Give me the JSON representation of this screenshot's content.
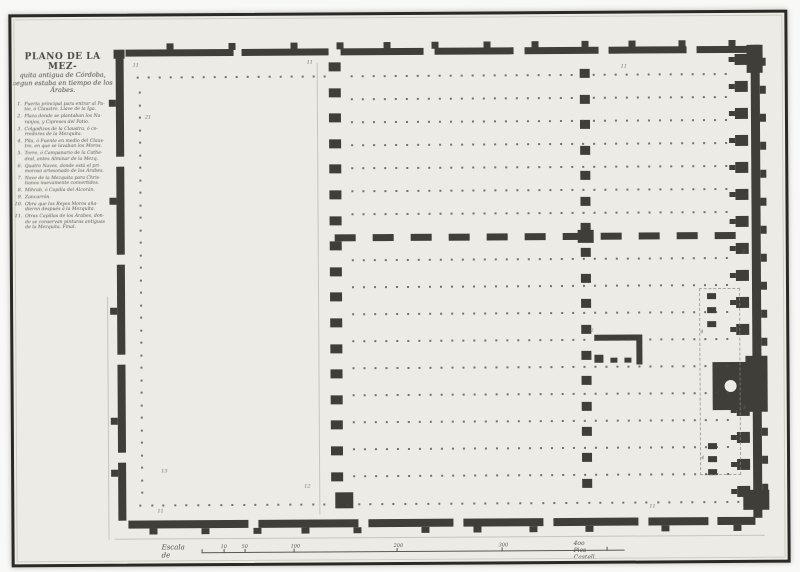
{
  "sheet": {
    "title_lines": [
      "PLANO DE LA MEZ-",
      "quita antigua de Córdoba,",
      "segun estaba en tiempo de los",
      "Árabes."
    ],
    "legend_items": [
      {
        "n": "1.",
        "text": "Puerta principal para entrar al Pa-\ntio, ó Claustro. Llave de la Iga."
      },
      {
        "n": "2.",
        "text": "Plaza donde se plantaban los Na-\nranjos, y Cipreses del Patio."
      },
      {
        "n": "3.",
        "text": "Colgadizos de la Claustra, ó co-\nrredores de la Mezquita."
      },
      {
        "n": "4.",
        "text": "Pila, ó Fuente en medio del Claus-\ntro, en que se lavaban los Moros."
      },
      {
        "n": "5.",
        "text": "Torre, ó Campanario de la Cathe-\ndral, antes Alminar de la Mezq."
      },
      {
        "n": "6.",
        "text": "Quatro Naves, donde está el pri-\nmoroso artesonado de los Árabes."
      },
      {
        "n": "7.",
        "text": "Nave de la Mezquita para Chris-\ntianos nuevamente convertidos."
      },
      {
        "n": "8.",
        "text": "Mihrab, ó Capilla del Alcorán."
      },
      {
        "n": "9.",
        "text": "Zancarrón."
      },
      {
        "n": "10.",
        "text": "Obra que los Reyes Moros aña-\ndieron después á la Mezquita."
      },
      {
        "n": "11.",
        "text": "Otras Capillas de los Árabes, don-\nde se conservan pinturas antiguas\nde la Mezquita. Final."
      }
    ],
    "scale": {
      "label": "Escala de",
      "end_label": "4oo Pies Castell.",
      "ticks": [
        {
          "x": 200,
          "t": ""
        },
        {
          "x": 222,
          "t": "10"
        },
        {
          "x": 243,
          "t": "50"
        },
        {
          "x": 292,
          "t": "100"
        },
        {
          "x": 395,
          "t": "200"
        },
        {
          "x": 500,
          "t": "300"
        },
        {
          "x": 605,
          "t": ""
        }
      ]
    }
  },
  "plan": {
    "ink": "#403e38",
    "dot": "#4c4a44",
    "walls": {
      "top_segments": [
        [
          127,
          48,
          108
        ],
        [
          243,
          48,
          87
        ],
        [
          342,
          48,
          83
        ],
        [
          436,
          48,
          79
        ],
        [
          526,
          48,
          74
        ],
        [
          610,
          48,
          78
        ],
        [
          698,
          48,
          56
        ]
      ],
      "top_buttresses": [
        168,
        230,
        292,
        338,
        385,
        433,
        485,
        533,
        583,
        630,
        680,
        730
      ],
      "left_segments": [
        [
          117,
          55,
          100
        ],
        [
          117,
          165,
          88
        ],
        [
          117,
          263,
          90
        ],
        [
          117,
          363,
          88
        ],
        [
          117,
          461,
          58
        ]
      ],
      "left_buttresses": [
        98,
        196,
        306,
        416,
        468
      ],
      "bottom_segments": [
        [
          127,
          519,
          120
        ],
        [
          257,
          519,
          100
        ],
        [
          367,
          519,
          85
        ],
        [
          462,
          519,
          80
        ],
        [
          552,
          519,
          85
        ],
        [
          647,
          519,
          60
        ],
        [
          716,
          519,
          38
        ]
      ],
      "bottom_buttresses": [
        148,
        200,
        252,
        300,
        352,
        420,
        472,
        528,
        584,
        660,
        732
      ],
      "right_wall": [
        752,
        47,
        9,
        473
      ],
      "right_buttresses": [
        60,
        88,
        116,
        144,
        172,
        200,
        228,
        256,
        284,
        312,
        340,
        430,
        458,
        486
      ]
    },
    "blocks": [
      [
        334,
        492,
        18,
        16
      ],
      [
        742,
        492,
        26,
        20
      ],
      [
        748,
        47,
        16,
        28
      ],
      [
        745,
        358,
        22,
        56
      ],
      [
        578,
        231,
        16,
        13
      ],
      [
        115,
        48,
        11,
        9
      ]
    ],
    "piers_a": {
      "x": 330,
      "y0": 62,
      "step": 25.6,
      "count": 17,
      "w": 12,
      "h": 9
    },
    "piers_b": {
      "x": 581,
      "y0": 70,
      "step": 25.6,
      "count": 17,
      "w": 10,
      "h": 9
    },
    "dashed_wall": {
      "y": 234,
      "x0": 335,
      "step": 38,
      "count": 11,
      "w": 21,
      "h": 7
    },
    "chapels": {
      "x": 736,
      "y0": 56,
      "step": 27,
      "count": 17,
      "w": 13,
      "h": 11,
      "skip": [
        11,
        12
      ]
    },
    "mihrab": {
      "rect": [
        712,
        364,
        42,
        48
      ],
      "hole": [
        724,
        382,
        12
      ]
    },
    "small_rects": [
      [
        707,
        295
      ],
      [
        707,
        309
      ],
      [
        707,
        323
      ],
      [
        707,
        445
      ],
      [
        707,
        458
      ],
      [
        707,
        471
      ]
    ],
    "small_chapel": [
      [
        594,
        336,
        46,
        6
      ],
      [
        636,
        336,
        6,
        30
      ],
      [
        594,
        356,
        9,
        8
      ],
      [
        610,
        359,
        7,
        5
      ],
      [
        624,
        359,
        7,
        5
      ]
    ],
    "chapel_outline": [
      699,
      290,
      39,
      185
    ],
    "grids": [
      {
        "x0": 352,
        "dx": 11,
        "cols": 35,
        "y0": 75,
        "dy": 23,
        "rows": 7
      },
      {
        "x0": 352,
        "dx": 11,
        "cols": 35,
        "y0": 259,
        "dy": 27,
        "rows": 9
      },
      {
        "x0": 138,
        "dx": 11,
        "cols": 18,
        "y0": 75,
        "dy": 1,
        "rows": 1
      },
      {
        "x0": 140,
        "dx": 1,
        "cols": 1,
        "y0": 90,
        "dy": 12.5,
        "rows": 33
      },
      {
        "x0": 138,
        "dx": 11.5,
        "cols": 53,
        "y0": 503,
        "dy": 1,
        "rows": 1
      }
    ],
    "faint_lines": [
      [
        107,
        295,
        1,
        243
      ],
      [
        113,
        537,
        650,
        1
      ],
      [
        318,
        62,
        1,
        452
      ]
    ],
    "numerals": [
      {
        "x": 134,
        "y": 62,
        "t": "11"
      },
      {
        "x": 308,
        "y": 60,
        "t": "11"
      },
      {
        "x": 622,
        "y": 66,
        "t": "11"
      },
      {
        "x": 146,
        "y": 114,
        "t": "21"
      },
      {
        "x": 160,
        "y": 468,
        "t": "13"
      },
      {
        "x": 303,
        "y": 484,
        "t": "12"
      },
      {
        "x": 156,
        "y": 508,
        "t": "11"
      },
      {
        "x": 648,
        "y": 506,
        "t": "11"
      },
      {
        "x": 590,
        "y": 330,
        "t": "2"
      },
      {
        "x": 742,
        "y": 252,
        "t": "3"
      },
      {
        "x": 700,
        "y": 332,
        "t": "4"
      },
      {
        "x": 742,
        "y": 408,
        "t": "3"
      },
      {
        "x": 700,
        "y": 458,
        "t": "4"
      }
    ]
  }
}
